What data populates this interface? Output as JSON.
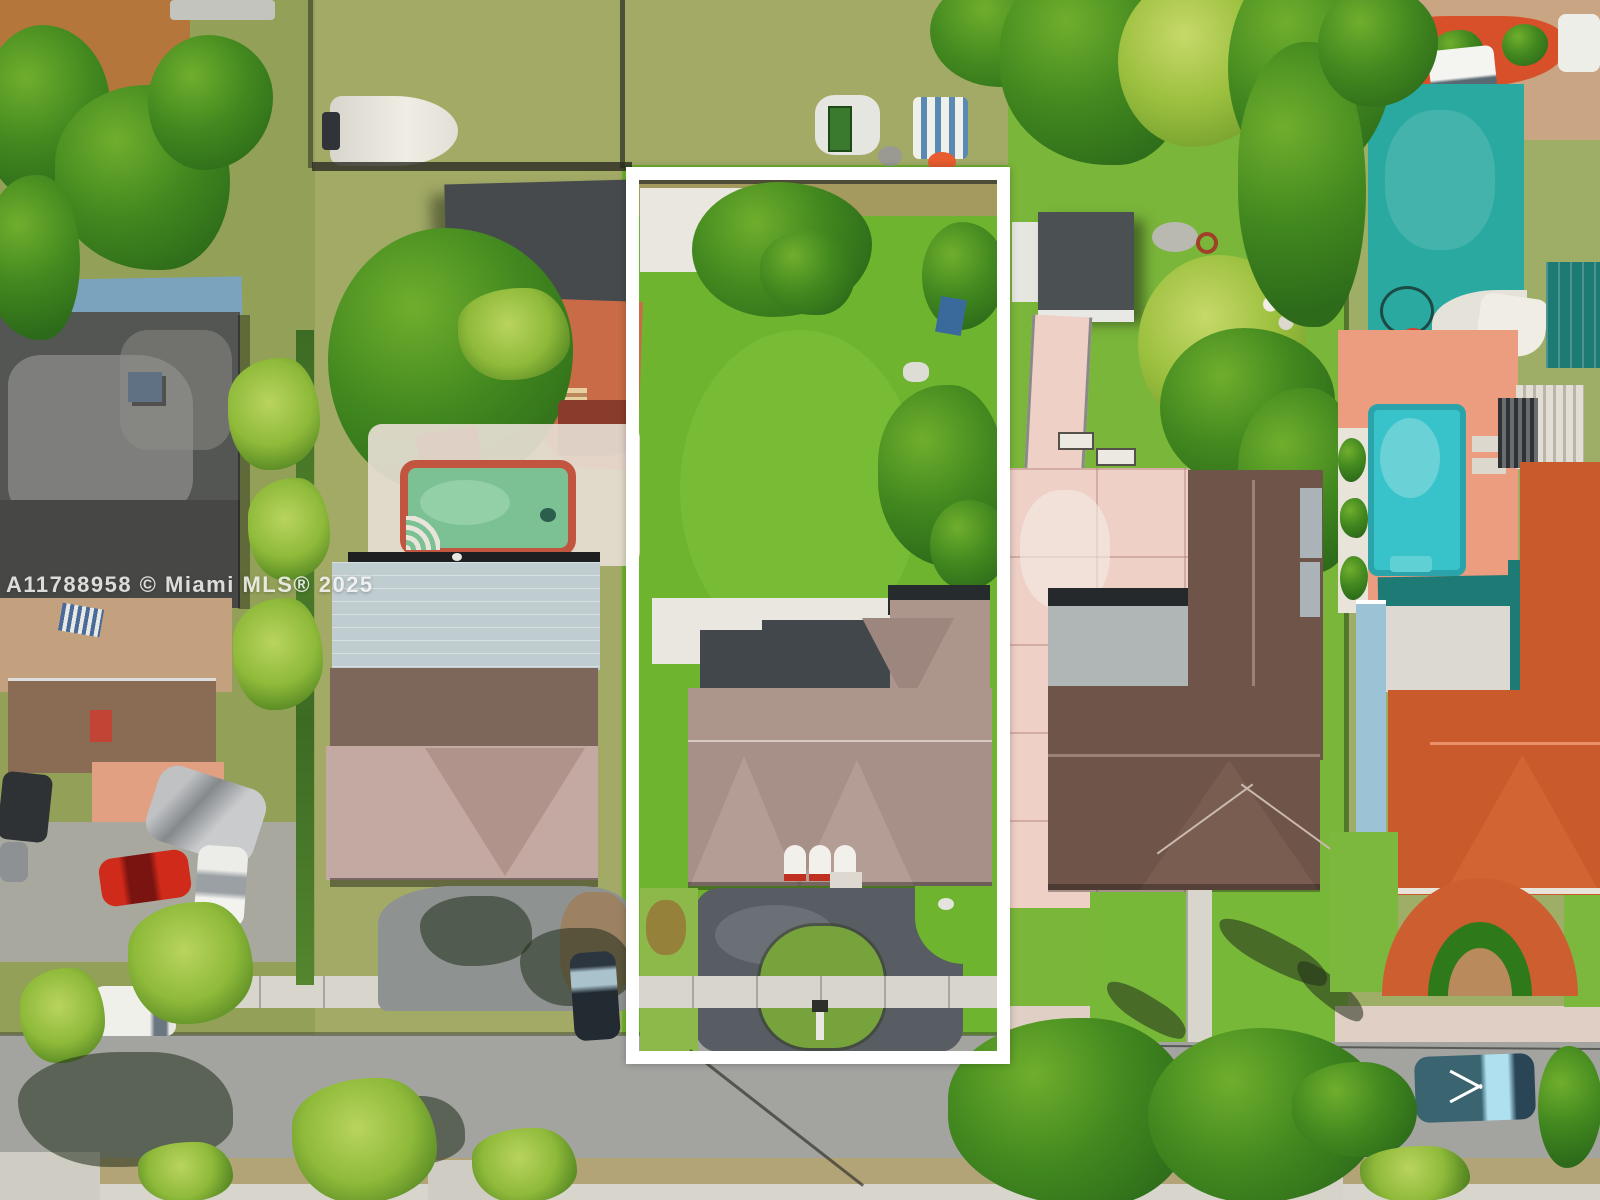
{
  "image": {
    "type": "aerial-drone-photograph",
    "width": 1600,
    "height": 1200,
    "description": "Overhead aerial view of a suburban residential block: five lots fronting a gray street at the bottom. The center lot — a deep property with a large bright-green lawn, tan tile-roof house and dark horseshoe driveway — is highlighted with a white rectangular outline. Neighboring lots show a dark flat-roof building with parked cars (left), a green pool and metal-roof house, a pink-paver patio home with dark brown tile roof, and a far-right lot with turquoise pool, coral deck and red Spanish-tile roofs."
  },
  "watermark": {
    "text": "A11788958 © Miami MLS® 2025"
  },
  "highlight": {
    "shape": "rectangle",
    "border_color": "#ffffff"
  },
  "colors": {
    "scrub": "#a3aa66",
    "scrub_dark": "#93a158",
    "lawn_bright": "#6fb42e",
    "lawn_mid": "#8db84a",
    "tree_dark": "#2d6b1a",
    "tree_mid": "#42881f",
    "tree_light": "#6fae2d",
    "tree_yellow": "#9dc03f",
    "palm_light": "#8fba3a",
    "roof_gray_dark": "#545653",
    "roof_gray_light": "#9b9b97",
    "roof_blue_strip": "#7ba3bd",
    "metal_blue": "#bfccd0",
    "shingle_brown": "#7d675a",
    "shingle_pink": "#c3a9a1",
    "tile_tan": "#ac968c",
    "tile_brown": "#6e5449",
    "tile_red": "#c85a2c",
    "shed_gray": "#464a4d",
    "flat_white": "#e9e7e0",
    "flat_gray": "#b0b6b6",
    "pool_green": "#7cc193",
    "pool_border": "#c25540",
    "pool_blue": "#38c3ca",
    "deck_coral": "#ec9d7f",
    "court_teal": "#2aa9a1",
    "teal_roof": "#1e7a74",
    "patio_terra": "#c86b46",
    "patio_tan": "#c3a07e",
    "patio_salmon": "#e2a083",
    "pavers_pink": "#eed0c6",
    "asphalt": "#575d63",
    "street": "#a3a3a0",
    "sidewalk": "#d8d5cd",
    "concrete": "#a8a89e",
    "dirt": "#c9a583",
    "mulch_red": "#d8502a",
    "wall_blue": "#9cc2d6",
    "car_red": "#d02a1a",
    "car_silver": "#bfc1c3",
    "car_white": "#ecece8",
    "car_dark": "#2e3234",
    "car_teal": "#3a6470",
    "outline": "#ffffff"
  }
}
